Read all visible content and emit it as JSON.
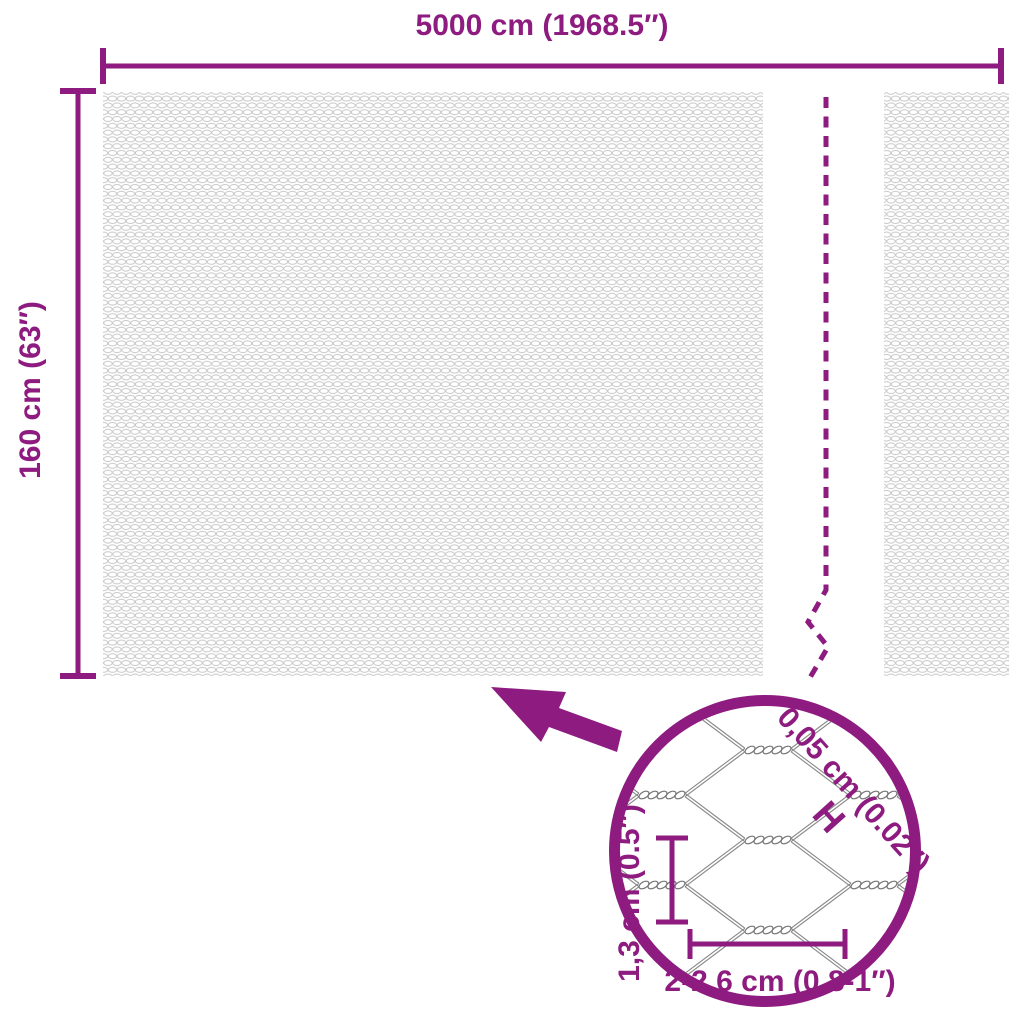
{
  "product_diagram": {
    "roll": {
      "width_label": "5000 cm (1968.5″)",
      "height_label": "160 cm (63″)"
    },
    "mesh_detail": {
      "wire_thickness_label": "0,05 cm (0.02″)",
      "thickness_marker": "H",
      "cell_height_label": "1,3 cm (0.5″)",
      "cell_width_label": "2-2,6 cm (0.8-1″)"
    },
    "colors": {
      "accent": "#8e1b7f",
      "mesh_texture": "#c9c9c9",
      "wire_gray": "#8a8a8a",
      "background": "#ffffff"
    }
  }
}
